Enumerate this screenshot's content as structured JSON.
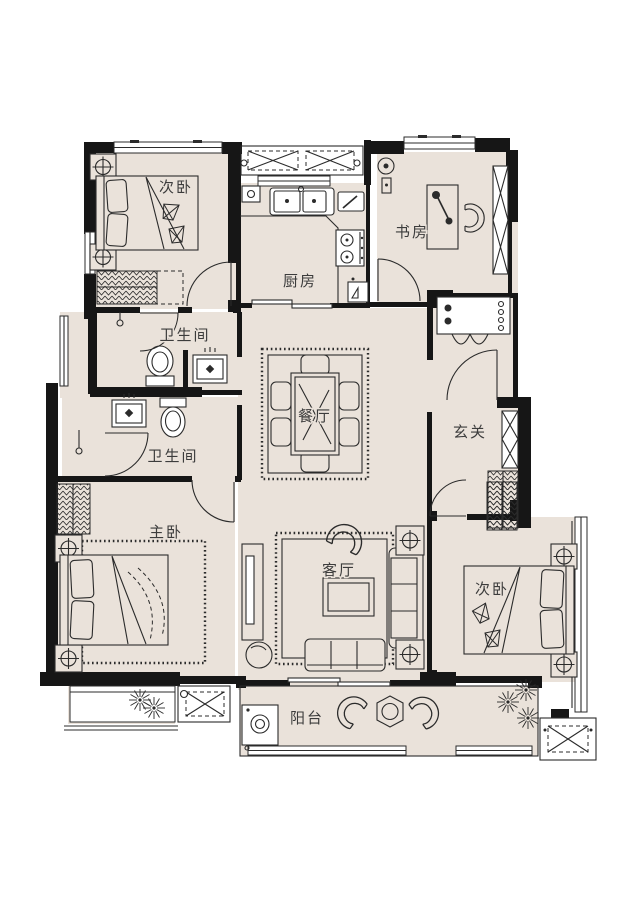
{
  "colors": {
    "background": "#ffffff",
    "floor": "#eae2da",
    "wall": "#161616",
    "line": "#2b2b2b",
    "label": "#3c3c3c"
  },
  "rooms": {
    "bedroom_top": {
      "label": "次卧"
    },
    "kitchen": {
      "label": "厨房"
    },
    "study": {
      "label": "书房"
    },
    "bath_upper": {
      "label": "卫生间"
    },
    "bath_lower": {
      "label": "卫生间"
    },
    "dining": {
      "label": "餐厅"
    },
    "foyer": {
      "label": "玄关"
    },
    "master_bedroom": {
      "label": "主卧"
    },
    "living": {
      "label": "客厅"
    },
    "bedroom_bottom": {
      "label": "次卧"
    },
    "balcony": {
      "label": "阳台"
    }
  }
}
